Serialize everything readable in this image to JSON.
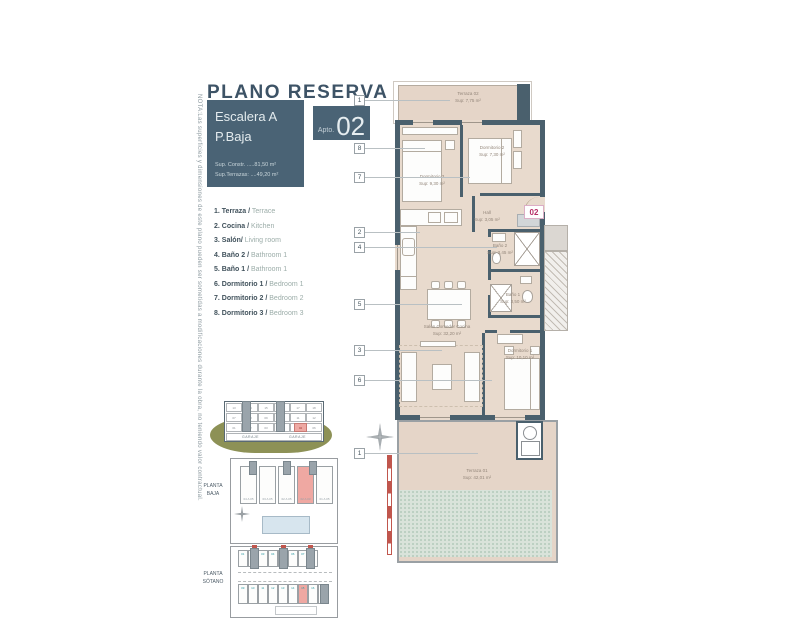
{
  "note": "NOTA:Las superficies y dimensiones de este plano pueden ser sometidas a modificaciones durante la obra, no teniendo valor contractual.",
  "header": {
    "title": "PLANO RESERVA",
    "stair_box": {
      "line1": "Escalera A",
      "line2": "P.Baja",
      "sup_constr": "Sup. Constr. .....81,50 m²",
      "sup_terraza": "Sup.Terrazas: ....49,20 m²"
    },
    "apto_box": {
      "label": "Apto.",
      "number": "02"
    }
  },
  "legend": [
    {
      "num": "1.",
      "es": "Terraza /",
      "en": "Terrace"
    },
    {
      "num": "2.",
      "es": "Cocina /",
      "en": "Kitchen"
    },
    {
      "num": "3.",
      "es": "Salón/",
      "en": "Living room"
    },
    {
      "num": "4.",
      "es": "Baño 2 /",
      "en": "Bathroom 1"
    },
    {
      "num": "5.",
      "es": "Baño 1 /",
      "en": "Bathroom 1"
    },
    {
      "num": "6.",
      "es": "Dormitorio 1 /",
      "en": "Bedroom 1"
    },
    {
      "num": "7.",
      "es": "Dormitorio 2 /",
      "en": "Bedroom 2"
    },
    {
      "num": "8.",
      "es": "Dormitorio 3 /",
      "en": "Bedroom 3"
    }
  ],
  "plan": {
    "badge": "02",
    "markers": [
      "1",
      "8",
      "7",
      "2",
      "4",
      "5",
      "3",
      "6",
      "1"
    ],
    "rooms": {
      "terraza2": {
        "name": "Terraza 02",
        "area": "Sup: 7,75 m²"
      },
      "dorm3": {
        "name": "Dormitorio 3",
        "area": "Sup: 9,30 m²"
      },
      "dorm2": {
        "name": "Dormitorio 2",
        "area": "Sup: 7,30 m²"
      },
      "hall": {
        "name": "Hall",
        "area": "Sup: 3,05 m²"
      },
      "bano2": {
        "name": "Baño 2",
        "area": "Sup: 3,45 m²"
      },
      "bano1": {
        "name": "Baño 1",
        "area": "Sup: 3,50 m²"
      },
      "salon": {
        "name": "Salón Comedor Cocina",
        "area": "Sup: 32,20 m²"
      },
      "dorm1": {
        "name": "Dormitorio 1",
        "area": "Sup: 10,10 m²"
      },
      "terraza1": {
        "name": "Terraza 01",
        "area": "Sup: 42,01 m²"
      }
    }
  },
  "mini": {
    "section": {
      "rows": [
        [
          "13",
          "14",
          "15",
          "16",
          "17",
          "18"
        ],
        [
          "07",
          "08",
          "09",
          "10",
          "11",
          "12"
        ],
        [
          "01",
          "02",
          "03",
          "04",
          "05",
          "06"
        ]
      ],
      "highlight": "02",
      "garaje_left": "GARAJE",
      "garaje_right": "GARAJE"
    },
    "baja": {
      "label1": "PLANTA",
      "label2": "BAJA",
      "units": [
        "04 A 05",
        "03 A 05",
        "02 A 05",
        "02 A 03",
        "01 A 05"
      ]
    },
    "sotano": {
      "label1": "PLANTA",
      "label2": "SÓTANO",
      "top": [
        "01",
        "02",
        "03",
        "04",
        "05",
        "06",
        "07",
        "08"
      ],
      "bottom": [
        "09",
        "10",
        "11",
        "12",
        "13",
        "14",
        "15",
        "16",
        "17"
      ]
    }
  },
  "colors": {
    "wall": "#4a606d",
    "floor_beige": "#e8dacd",
    "accent_magenta": "#b62d66",
    "highlight_pink": "#efa8a2",
    "garden_teal": "#d9e3da",
    "ground_olive": "#8d9156",
    "scalebar_red": "#c0564d"
  }
}
